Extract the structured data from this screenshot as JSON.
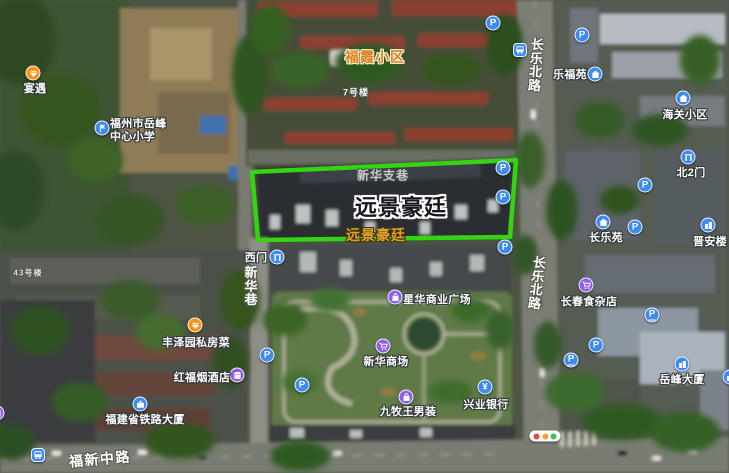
{
  "main_label": {
    "text": "远景豪廷",
    "x": 401,
    "y": 206,
    "font_size": 22
  },
  "highlight": {
    "label": "远景豪廷",
    "polygon_points": "252,172 516,160 510,237 258,240",
    "color": "#33d411",
    "stroke_width": 4.5
  },
  "area_labels": [
    {
      "name": "fuxia-community-label",
      "text": "福霞小区",
      "x": 375,
      "y": 57,
      "font_size": 14,
      "color": "#e0821a",
      "outline": "light"
    },
    {
      "name": "yuanjing-haoting-area-label",
      "text": "远景豪廷",
      "x": 376,
      "y": 235,
      "font_size": 14,
      "color": "#e2a02a",
      "outline": "dark"
    }
  ],
  "misc_labels": [
    {
      "name": "building-7-label",
      "text": "7号楼",
      "x": 356,
      "y": 92,
      "font_size": 9,
      "opacity": 0.95
    },
    {
      "name": "building-43-label",
      "text": "43号楼",
      "x": 28,
      "y": 273,
      "font_size": 8,
      "opacity": 0.8
    },
    {
      "name": "xinhua-branch-lane-label",
      "text": "新华支巷",
      "x": 383,
      "y": 175,
      "font_size": 12,
      "opacity": 0.72
    }
  ],
  "road_labels": [
    {
      "name": "changle-north-road-label-top",
      "text": "长乐北路",
      "x": 536,
      "y": 38,
      "vertical": true,
      "font_size": 13,
      "rotate": 4
    },
    {
      "name": "changle-north-road-label-bottom",
      "text": "长乐北路",
      "x": 537,
      "y": 256,
      "vertical": true,
      "font_size": 13,
      "rotate": 7
    },
    {
      "name": "xinhua-lane-label",
      "text": "新华巷",
      "x": 251,
      "y": 266,
      "vertical": true,
      "font_size": 13,
      "rotate": 0
    },
    {
      "name": "fuxin-middle-road-label",
      "text": "福新中路",
      "x": 100,
      "y": 459,
      "vertical": false,
      "font_size": 14,
      "rotate": -5
    }
  ],
  "pois": [
    {
      "name": "yanyu-restaurant",
      "text": "宴遇",
      "icon": "food-icon",
      "color": "#fa9214",
      "ix": 33,
      "iy": 73,
      "tx": 35,
      "ty": 88
    },
    {
      "name": "yuefeng-central-primary-school",
      "lines": [
        "福州市岳峰",
        "中心小学"
      ],
      "icon": "school-flag-icon",
      "color": "#3d8bf2",
      "ix": 102,
      "iy": 128,
      "tx": 110,
      "ty": 131,
      "align": "left"
    },
    {
      "name": "west-gate",
      "text": "西门",
      "icon": "gate-icon",
      "color": "#3d8bf2",
      "ix": 277,
      "iy": 257,
      "tx": 256,
      "ty": 257
    },
    {
      "name": "lefuyuan-community",
      "text": "乐福苑",
      "icon": "house-icon",
      "color": "#3d8bf2",
      "ix": 595,
      "iy": 74,
      "tx": 570,
      "ty": 74
    },
    {
      "name": "haiguan-community",
      "text": "海关小区",
      "icon": "house-icon",
      "color": "#3d8bf2",
      "ix": 683,
      "iy": 98,
      "tx": 685,
      "ty": 114
    },
    {
      "name": "north-gate-2",
      "text": "北2门",
      "icon": "gate-icon",
      "color": "#3d8bf2",
      "ix": 688,
      "iy": 157,
      "tx": 691,
      "ty": 172
    },
    {
      "name": "changleyuan-community",
      "text": "长乐苑",
      "icon": "house-icon",
      "color": "#3d8bf2",
      "ix": 603,
      "iy": 222,
      "tx": 606,
      "ty": 237
    },
    {
      "name": "jinanlou-building",
      "text": "晋安楼",
      "icon": "building-icon",
      "color": "#3d8bf2",
      "ix": 708,
      "iy": 225,
      "tx": 710,
      "ty": 241
    },
    {
      "name": "changchun-grocery",
      "text": "长春食杂店",
      "icon": "cart-icon",
      "color": "#8f5fe8",
      "ix": 586,
      "iy": 285,
      "tx": 589,
      "ty": 301
    },
    {
      "name": "yuefeng-tower",
      "text": "岳峰大厦",
      "icon": "building-icon",
      "color": "#3d8bf2",
      "ix": 682,
      "iy": 364,
      "tx": 682,
      "ty": 379
    },
    {
      "name": "xinghua-commercial-plaza",
      "text": "星华商业广场",
      "icon": "bag-icon",
      "color": "#8f5fe8",
      "ix": 395,
      "iy": 297,
      "tx": 437,
      "ty": 299
    },
    {
      "name": "xinhua-mall",
      "text": "新华商场",
      "icon": "cart-icon",
      "color": "#8f5fe8",
      "ix": 383,
      "iy": 346,
      "tx": 386,
      "ty": 361
    },
    {
      "name": "joeone-menswear",
      "text": "九牧王男装",
      "icon": "bag-icon",
      "color": "#8f5fe8",
      "ix": 406,
      "iy": 397,
      "tx": 408,
      "ty": 411
    },
    {
      "name": "industrial-bank",
      "text": "兴业银行",
      "icon": "yen-icon",
      "color": "#3d8bf2",
      "ix": 485,
      "iy": 387,
      "tx": 486,
      "ty": 404
    },
    {
      "name": "fengzeyuan-private-kitchen",
      "text": "丰泽园私房菜",
      "icon": "food-icon",
      "color": "#fa9214",
      "ix": 195,
      "iy": 325,
      "tx": 196,
      "ty": 342
    },
    {
      "name": "hongfu-tobacco-liquor-shop",
      "text": "红福烟酒店",
      "icon": "store-icon",
      "color": "#8f5fe8",
      "ix": 237,
      "iy": 375,
      "tx": 202,
      "ty": 377
    },
    {
      "name": "fujian-railway-tower",
      "text": "福建省铁路大厦",
      "icon": "briefcase-icon",
      "color": "#3d8bf2",
      "ix": 140,
      "iy": 404,
      "tx": 145,
      "ty": 419
    }
  ],
  "standalone_icons": [
    {
      "icon": "parking-icon",
      "x": 493,
      "y": 23
    },
    {
      "icon": "parking-icon",
      "x": 582,
      "y": 35
    },
    {
      "icon": "parking-icon",
      "x": 503,
      "y": 168
    },
    {
      "icon": "parking-icon",
      "x": 503,
      "y": 197
    },
    {
      "icon": "parking-icon",
      "x": 505,
      "y": 247
    },
    {
      "icon": "parking-icon",
      "x": 645,
      "y": 185
    },
    {
      "icon": "parking-icon",
      "x": 635,
      "y": 227
    },
    {
      "icon": "parking-icon",
      "x": 596,
      "y": 345
    },
    {
      "icon": "parking-icon",
      "x": 267,
      "y": 355
    },
    {
      "icon": "parking-icon",
      "x": 302,
      "y": 385
    },
    {
      "icon": "parking-entrance-icon",
      "x": 652,
      "y": 315
    },
    {
      "icon": "parking-entrance-icon",
      "x": 571,
      "y": 360
    },
    {
      "icon": "bus-icon",
      "x": 520,
      "y": 50
    },
    {
      "icon": "bus-icon",
      "x": 38,
      "y": 455
    },
    {
      "icon": "store-icon",
      "color": "#8f5fe8",
      "x": -3,
      "y": 413
    },
    {
      "icon": "building-icon",
      "color": "#3d8bf2",
      "x": 730,
      "y": 377
    }
  ],
  "traffic_light": {
    "x": 545,
    "y": 436,
    "colors": [
      "#e5473c",
      "#f0a32f",
      "#39c25c"
    ]
  },
  "colors": {
    "highlight_green": "#33d411",
    "poi_blue": "#3d8bf2",
    "poi_purple": "#8f5fe8",
    "poi_orange": "#fa9214",
    "area_label_orange": "#e0821a"
  }
}
